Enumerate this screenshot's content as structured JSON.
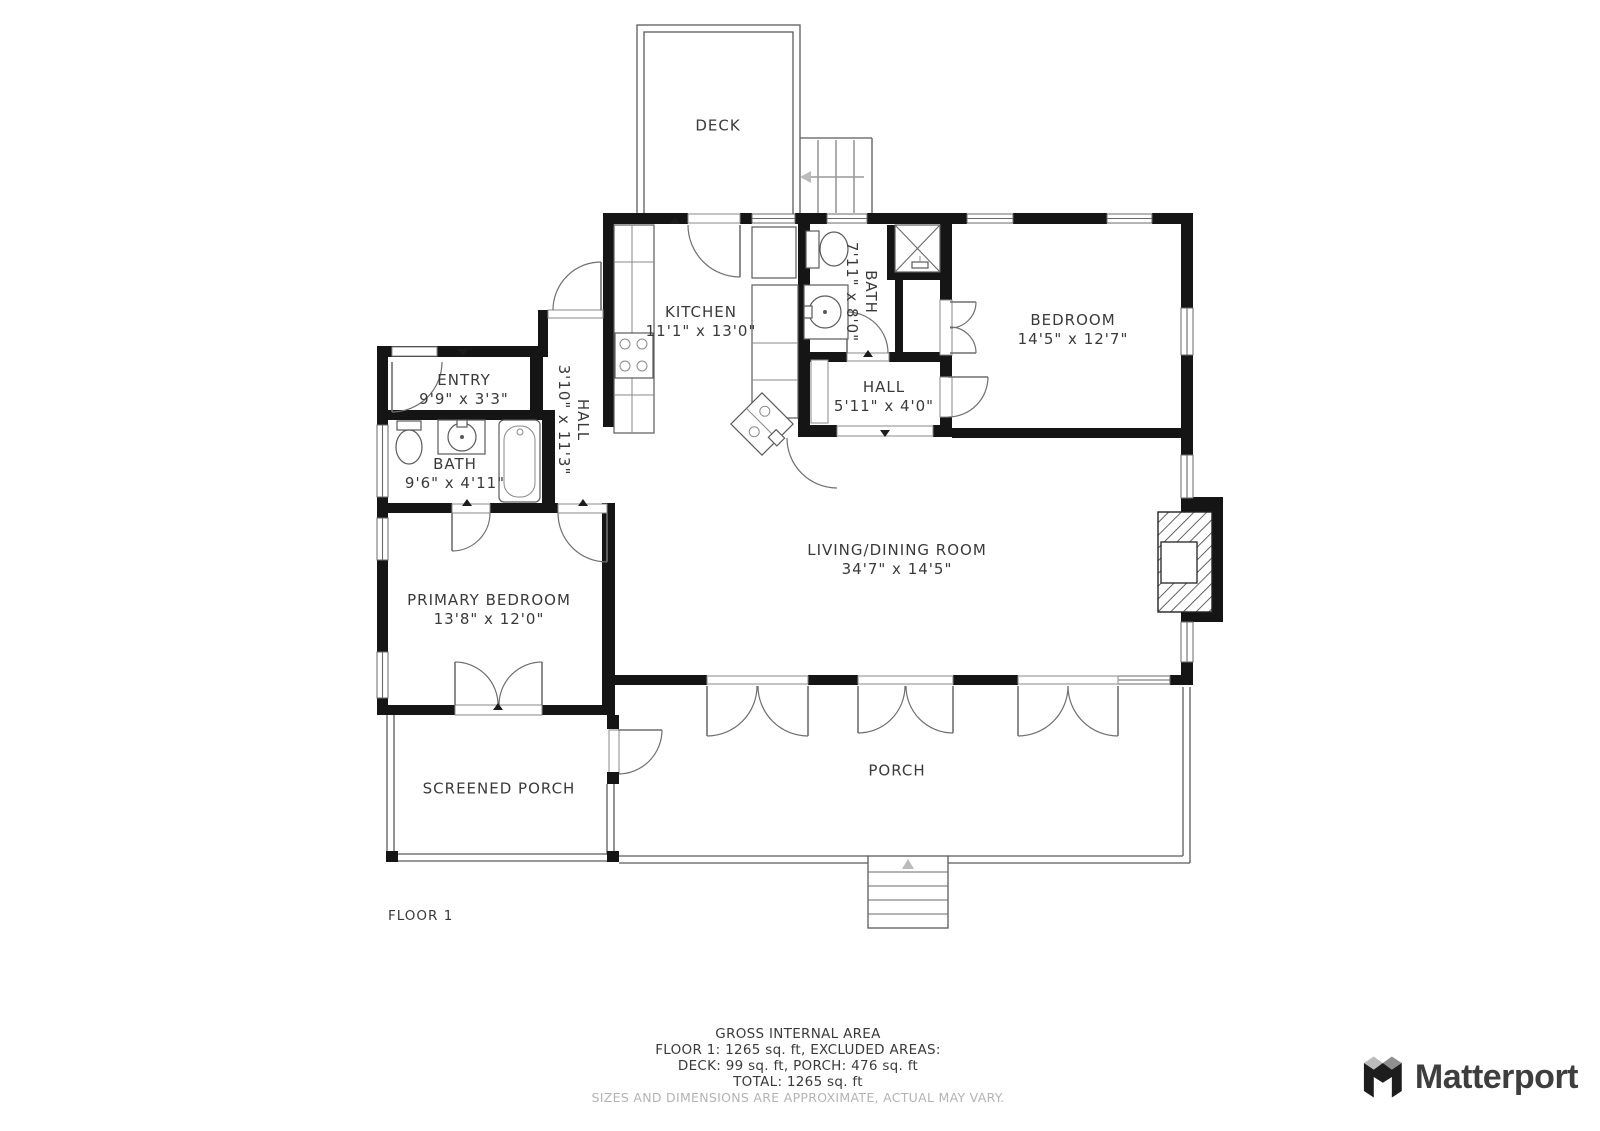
{
  "rooms": {
    "deck": {
      "name": "DECK"
    },
    "kitchen": {
      "name": "KITCHEN",
      "dims": "11'1\" x 13'0\""
    },
    "bath_top": {
      "name": "BATH",
      "dims": "7'11\" x 8'0\""
    },
    "bedroom": {
      "name": "BEDROOM",
      "dims": "14'5\" x 12'7\""
    },
    "entry": {
      "name": "ENTRY",
      "dims": "9'9\" x 3'3\""
    },
    "hall_west": {
      "name": "HALL",
      "dims": "3'10\" x 11'3\""
    },
    "bath_west": {
      "name": "BATH",
      "dims": "9'6\" x 4'11\""
    },
    "hall_center": {
      "name": "HALL",
      "dims": "5'11\" x 4'0\""
    },
    "living": {
      "name": "LIVING/DINING ROOM",
      "dims": "34'7\" x 14'5\""
    },
    "primary": {
      "name": "PRIMARY BEDROOM",
      "dims": "13'8\" x 12'0\""
    },
    "screened_porch": {
      "name": "SCREENED PORCH"
    },
    "porch": {
      "name": "PORCH"
    }
  },
  "floor_label": "FLOOR 1",
  "footer": {
    "lines": [
      "GROSS INTERNAL AREA",
      "FLOOR 1: 1265 sq. ft, EXCLUDED AREAS:",
      "DECK: 99 sq. ft, PORCH: 476 sq. ft",
      "TOTAL: 1265 sq. ft",
      "SIZES AND DIMENSIONS ARE APPROXIMATE, ACTUAL MAY VARY."
    ]
  },
  "brand": {
    "name": "Matterport"
  },
  "colors": {
    "wall": "#151515",
    "line": "#5a5a5a",
    "text": "#3a3a3a",
    "muted": "#b3b3b3"
  }
}
